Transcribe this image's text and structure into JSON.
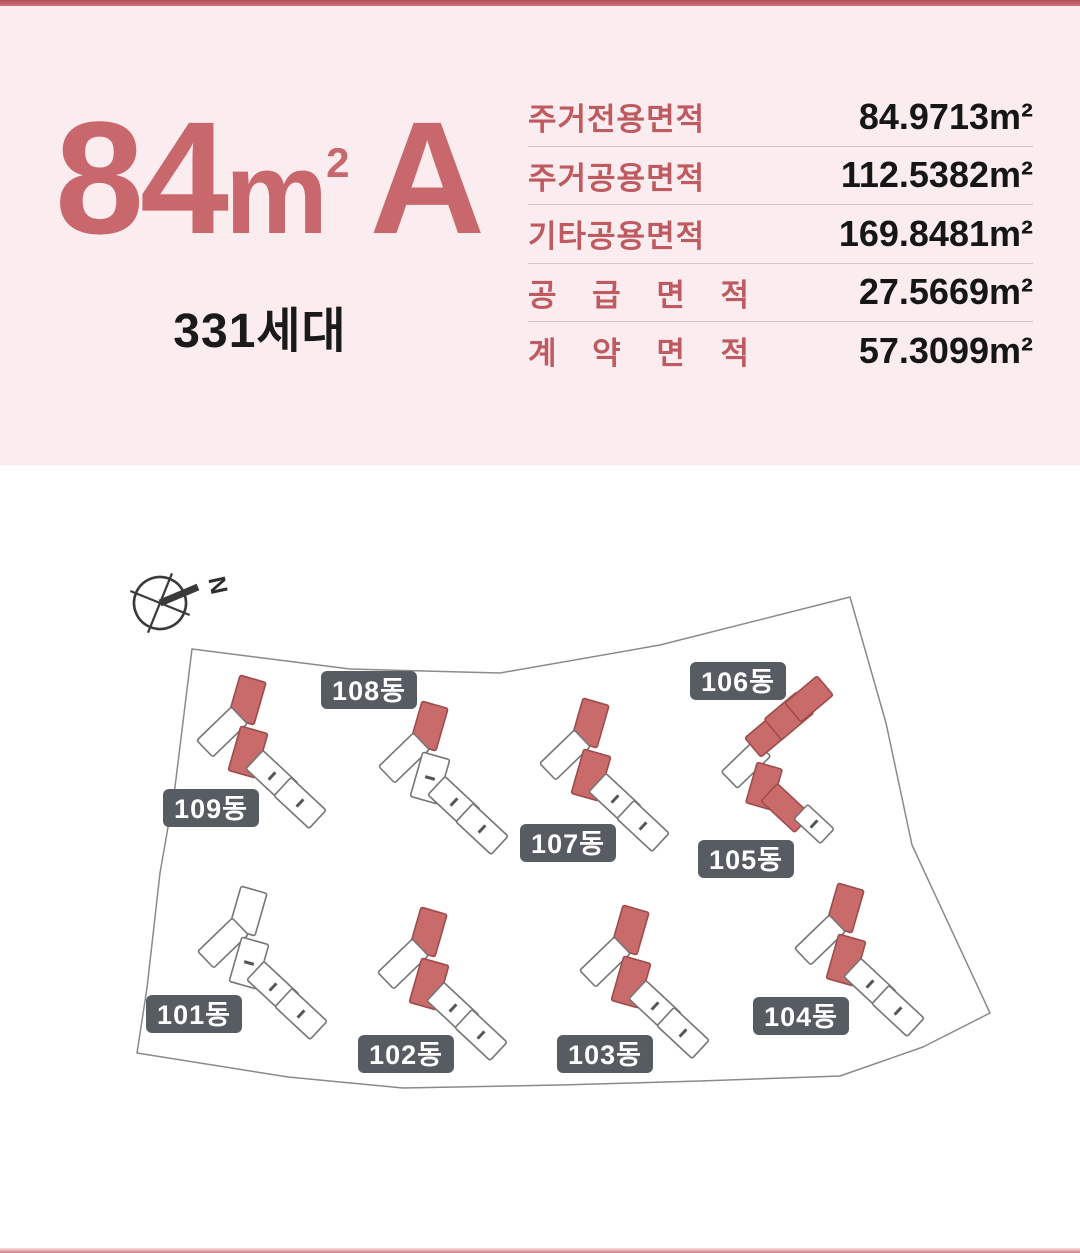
{
  "banner": {
    "type_title": {
      "prefix": "84",
      "unit": "m",
      "sup": "2",
      "suffix": "A"
    },
    "households": "331세대",
    "table": {
      "rows": [
        {
          "label": "주거전용면적",
          "value": "84.9713",
          "unit": "m²"
        },
        {
          "label": "주거공용면적",
          "value": "112.5382",
          "unit": "m²"
        },
        {
          "label": "기타공용면적",
          "value": "169.8481",
          "unit": "m²"
        },
        {
          "label": "공 급 면 적",
          "value": "27.5669",
          "unit": "m²"
        },
        {
          "label": "계 약 면 적",
          "value": "57.3099",
          "unit": "m²"
        }
      ]
    }
  },
  "site_plan": {
    "compass_label": "N",
    "colors": {
      "highlight_fill": "#c96b6b",
      "highlight_stroke": "#9e4b4b",
      "plain_fill": "#ffffff",
      "plain_stroke": "#767676",
      "boundary_stroke": "#8a8a8a",
      "label_bg": "#575c62",
      "label_text": "#ffffff",
      "banner_label": "#bf5a60",
      "title_color": "#c8686c"
    },
    "boundary_points": [
      [
        192,
        649
      ],
      [
        350,
        669
      ],
      [
        500,
        673
      ],
      [
        660,
        645
      ],
      [
        850,
        597
      ],
      [
        886,
        723
      ],
      [
        912,
        845
      ],
      [
        990,
        1013
      ],
      [
        923,
        1047
      ],
      [
        840,
        1076
      ],
      [
        700,
        1081
      ],
      [
        560,
        1085
      ],
      [
        403,
        1088
      ],
      [
        288,
        1077
      ],
      [
        137,
        1053
      ],
      [
        147,
        988
      ],
      [
        160,
        873
      ],
      [
        175,
        787
      ]
    ],
    "buildings": [
      {
        "name": "101동",
        "highlighted": false,
        "label": {
          "x": 194,
          "y": 1014
        },
        "segments": [
          {
            "x": 248,
            "y": 911,
            "w": 27,
            "h": 44,
            "r": 16,
            "red": false
          },
          {
            "x": 223,
            "y": 943,
            "w": 23,
            "h": 48,
            "r": 46,
            "red": false
          },
          {
            "x": 249,
            "y": 963,
            "w": 28,
            "h": 46,
            "r": 16,
            "red": false,
            "tick": true
          },
          {
            "x": 273,
            "y": 987,
            "w": 25,
            "h": 48,
            "r": -47,
            "red": false,
            "tick": true
          },
          {
            "x": 301,
            "y": 1014,
            "w": 25,
            "h": 48,
            "r": -47,
            "red": false,
            "tick": true
          }
        ]
      },
      {
        "name": "102동",
        "highlighted": true,
        "label": {
          "x": 406,
          "y": 1054
        },
        "segments": [
          {
            "x": 428,
            "y": 932,
            "w": 27,
            "h": 44,
            "r": 16,
            "red": true
          },
          {
            "x": 403,
            "y": 964,
            "w": 23,
            "h": 48,
            "r": 46,
            "red": false
          },
          {
            "x": 429,
            "y": 984,
            "w": 28,
            "h": 46,
            "r": 16,
            "red": true
          },
          {
            "x": 453,
            "y": 1008,
            "w": 25,
            "h": 48,
            "r": -47,
            "red": false,
            "tick": true
          },
          {
            "x": 481,
            "y": 1035,
            "w": 25,
            "h": 48,
            "r": -47,
            "red": false,
            "tick": true
          }
        ]
      },
      {
        "name": "103동",
        "highlighted": true,
        "label": {
          "x": 605,
          "y": 1054
        },
        "segments": [
          {
            "x": 630,
            "y": 930,
            "w": 27,
            "h": 44,
            "r": 16,
            "red": true
          },
          {
            "x": 605,
            "y": 962,
            "w": 23,
            "h": 48,
            "r": 46,
            "red": false
          },
          {
            "x": 631,
            "y": 982,
            "w": 28,
            "h": 46,
            "r": 16,
            "red": true
          },
          {
            "x": 655,
            "y": 1006,
            "w": 25,
            "h": 48,
            "r": -47,
            "red": false,
            "tick": true
          },
          {
            "x": 683,
            "y": 1033,
            "w": 25,
            "h": 48,
            "r": -47,
            "red": false,
            "tick": true
          }
        ]
      },
      {
        "name": "104동",
        "highlighted": true,
        "label": {
          "x": 801,
          "y": 1016
        },
        "segments": [
          {
            "x": 845,
            "y": 908,
            "w": 27,
            "h": 44,
            "r": 16,
            "red": true
          },
          {
            "x": 820,
            "y": 940,
            "w": 23,
            "h": 48,
            "r": 46,
            "red": false
          },
          {
            "x": 846,
            "y": 960,
            "w": 28,
            "h": 46,
            "r": 16,
            "red": true
          },
          {
            "x": 870,
            "y": 984,
            "w": 25,
            "h": 48,
            "r": -47,
            "red": false,
            "tick": true
          },
          {
            "x": 898,
            "y": 1011,
            "w": 25,
            "h": 48,
            "r": -47,
            "red": false,
            "tick": true
          }
        ]
      },
      {
        "name": "105동",
        "highlighted": true,
        "label": {
          "x": 746,
          "y": 859
        },
        "segments": [
          {
            "x": 746,
            "y": 764,
            "w": 23,
            "h": 46,
            "r": 46,
            "red": false
          },
          {
            "x": 764,
            "y": 786,
            "w": 26,
            "h": 42,
            "r": 16,
            "red": true
          },
          {
            "x": 786,
            "y": 808,
            "w": 24,
            "h": 46,
            "r": -47,
            "red": true
          },
          {
            "x": 814,
            "y": 824,
            "w": 20,
            "h": 36,
            "r": -47,
            "red": false,
            "tick": true
          }
        ]
      },
      {
        "name": "106동",
        "highlighted": true,
        "label": {
          "x": 738,
          "y": 681
        },
        "segments": [
          {
            "x": 769,
            "y": 734,
            "w": 25,
            "h": 42,
            "r": 50,
            "red": true
          },
          {
            "x": 789,
            "y": 716,
            "w": 27,
            "h": 42,
            "r": 50,
            "red": true
          },
          {
            "x": 809,
            "y": 699,
            "w": 25,
            "h": 42,
            "r": 50,
            "red": true
          }
        ]
      },
      {
        "name": "107동",
        "highlighted": true,
        "label": {
          "x": 568,
          "y": 843
        },
        "segments": [
          {
            "x": 590,
            "y": 723,
            "w": 27,
            "h": 44,
            "r": 16,
            "red": true
          },
          {
            "x": 565,
            "y": 755,
            "w": 23,
            "h": 48,
            "r": 46,
            "red": false
          },
          {
            "x": 591,
            "y": 775,
            "w": 28,
            "h": 46,
            "r": 16,
            "red": true
          },
          {
            "x": 615,
            "y": 799,
            "w": 25,
            "h": 48,
            "r": -47,
            "red": false,
            "tick": true
          },
          {
            "x": 643,
            "y": 826,
            "w": 25,
            "h": 48,
            "r": -47,
            "red": false,
            "tick": true
          }
        ]
      },
      {
        "name": "108동",
        "highlighted": true,
        "label": {
          "x": 369,
          "y": 690
        },
        "segments": [
          {
            "x": 429,
            "y": 726,
            "w": 27,
            "h": 44,
            "r": 16,
            "red": true
          },
          {
            "x": 404,
            "y": 758,
            "w": 23,
            "h": 48,
            "r": 46,
            "red": false
          },
          {
            "x": 430,
            "y": 778,
            "w": 28,
            "h": 46,
            "r": 16,
            "red": false,
            "tick": true
          },
          {
            "x": 454,
            "y": 802,
            "w": 25,
            "h": 48,
            "r": -47,
            "red": false,
            "tick": true
          },
          {
            "x": 482,
            "y": 829,
            "w": 25,
            "h": 48,
            "r": -47,
            "red": false,
            "tick": true
          }
        ]
      },
      {
        "name": "109동",
        "highlighted": true,
        "label": {
          "x": 211,
          "y": 808
        },
        "segments": [
          {
            "x": 247,
            "y": 700,
            "w": 27,
            "h": 44,
            "r": 16,
            "red": true
          },
          {
            "x": 222,
            "y": 732,
            "w": 23,
            "h": 48,
            "r": 46,
            "red": false
          },
          {
            "x": 248,
            "y": 752,
            "w": 28,
            "h": 46,
            "r": 16,
            "red": true
          },
          {
            "x": 272,
            "y": 776,
            "w": 25,
            "h": 48,
            "r": -47,
            "red": false,
            "tick": true
          },
          {
            "x": 300,
            "y": 803,
            "w": 25,
            "h": 48,
            "r": -47,
            "red": false,
            "tick": true
          }
        ]
      }
    ]
  }
}
